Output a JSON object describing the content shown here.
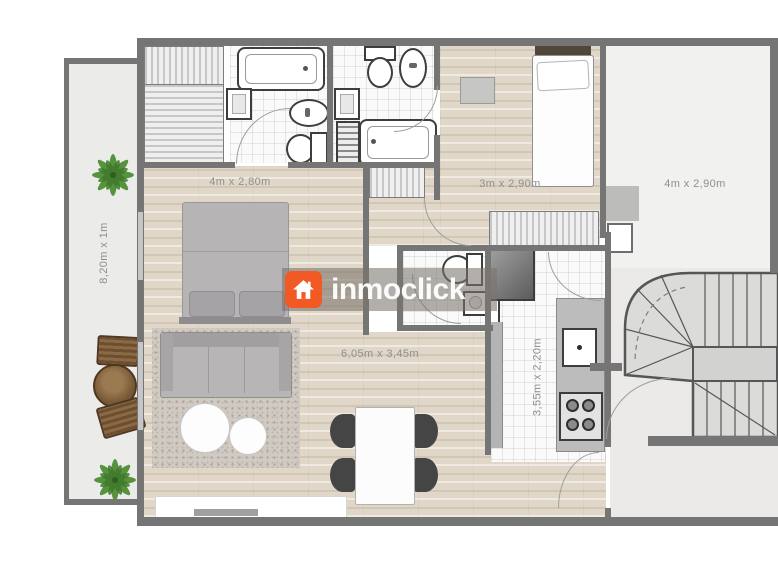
{
  "watermark": {
    "brand": "inmoclick",
    "accent_color": "#f15a25"
  },
  "plan": {
    "rooms": {
      "balcony": {
        "label": "8,20m x 1m"
      },
      "bedroom_main": {
        "label": "4m x 2,80m"
      },
      "bedroom_second": {
        "label": "3m x 2,90m"
      },
      "room_right": {
        "label": "4m x 2,90m"
      },
      "living_dining": {
        "label": "6,05m x 3,45m"
      },
      "kitchen": {
        "label": "3,55m x 2,20m"
      }
    }
  }
}
